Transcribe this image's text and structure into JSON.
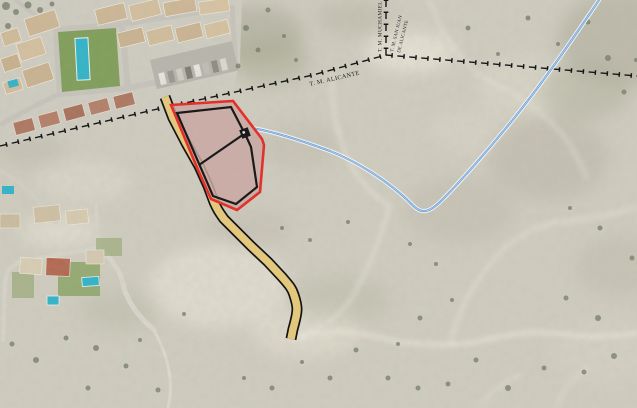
{
  "map": {
    "description": "Aerial site location plan with municipal boundaries, site parcel, access path and pipeline",
    "labels": {
      "tm_alicante": "T. M. ALICANTE",
      "tm_muchamiel": "T. M. MUCHAMIEL",
      "tm_san_juan_line1": "T. M. SAN JUAN",
      "tm_san_juan_line2": "DE ALICANTE"
    },
    "colors": {
      "terrain": "#d0cdc0",
      "site_outline": "#e2312b",
      "site_fill": "#c9a8a3",
      "parcel_lines": "#1a1a1a",
      "access_path_fill": "#e3c77d",
      "access_path_border": "#141414",
      "pipeline": "#5b94cc",
      "pipeline_casing": "#eef2f6",
      "municipal_boundary": "#171717",
      "pool": "#2fb4c9"
    }
  }
}
